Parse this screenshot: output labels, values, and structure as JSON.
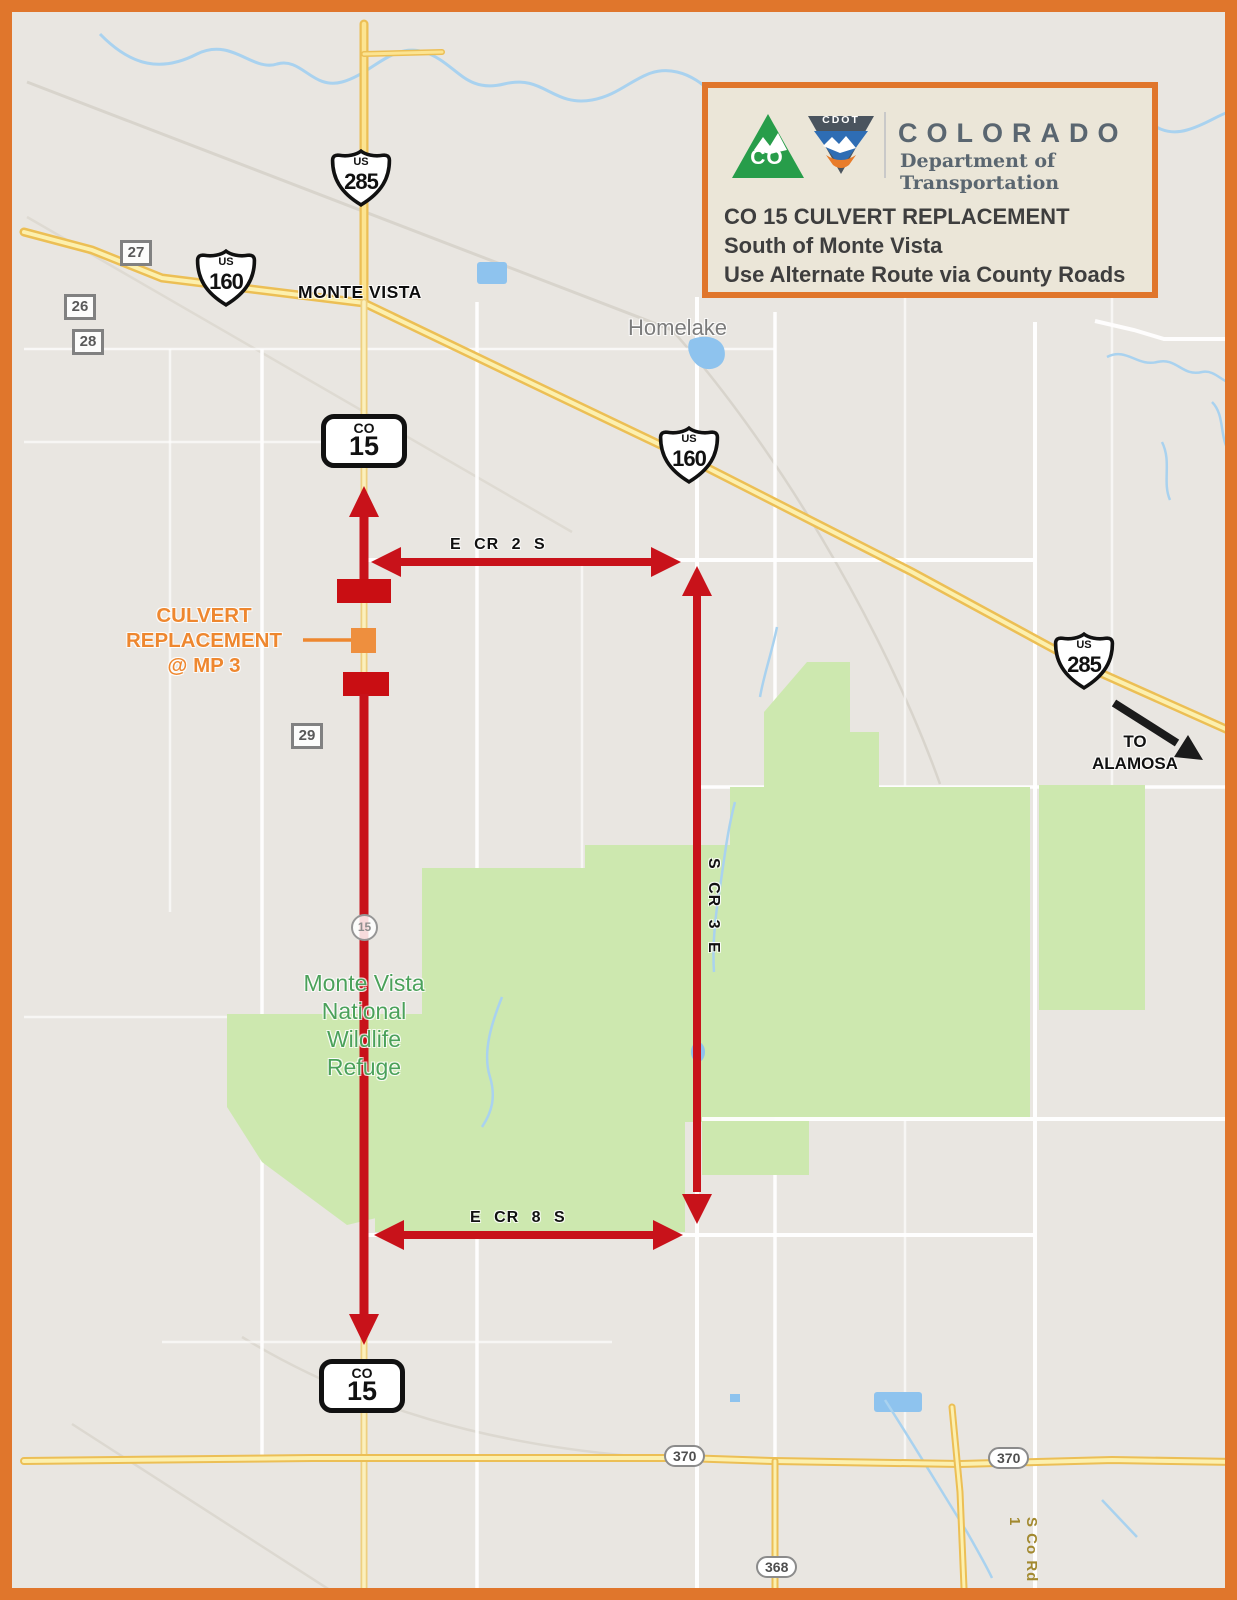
{
  "header": {
    "logo": {
      "co": "CO",
      "cdot": "CDOT"
    },
    "brand": "COLORADO",
    "brand_sub": [
      "Department of",
      "Transportation"
    ],
    "title": "CO 15 CULVERT REPLACEMENT",
    "subtitle": [
      "South of Monte Vista",
      "Use Alternate Route via County Roads"
    ]
  },
  "towns": {
    "monte_vista": "MONTE VISTA",
    "homelake": "Homelake"
  },
  "refuge_label": [
    "Monte Vista",
    "National",
    "Wildlife",
    "Refuge"
  ],
  "culvert_callout": [
    "CULVERT",
    "REPLACEMENT",
    "@ MP 3"
  ],
  "to_alamosa": [
    "TO",
    "ALAMOSA"
  ],
  "detour_labels": {
    "e_cr_2_s": "E CR 2 S",
    "s_cr_3_e": "S CR 3 E",
    "e_cr_8_s": "E CR 8 S"
  },
  "shields": {
    "us285_north": {
      "system": "US",
      "number": "285"
    },
    "us160_west": {
      "system": "US",
      "number": "160"
    },
    "us160_mid": {
      "system": "US",
      "number": "160"
    },
    "us285_east": {
      "system": "US",
      "number": "285"
    },
    "co15_north": {
      "prefix": "CO",
      "number": "15"
    },
    "co15_south": {
      "prefix": "CO",
      "number": "15"
    },
    "sh15_small": "15"
  },
  "county_markers": {
    "m27": "27",
    "m26": "26",
    "m28": "28",
    "m29": "29"
  },
  "route_ovals": {
    "r370_west": "370",
    "r370_east": "370",
    "r368": "368"
  },
  "road_labels": {
    "s_co_rd_1": "S Co Rd 1"
  },
  "colors": {
    "border_orange": "#E0762C",
    "detour_red": "#C8121A",
    "culvert_orange": "#EE8F3E",
    "refuge_green": "#CDE8AF",
    "highway_yellow": "#F5CD5C",
    "water_blue": "#A9D2EF",
    "map_background": "#E9E6E1"
  }
}
